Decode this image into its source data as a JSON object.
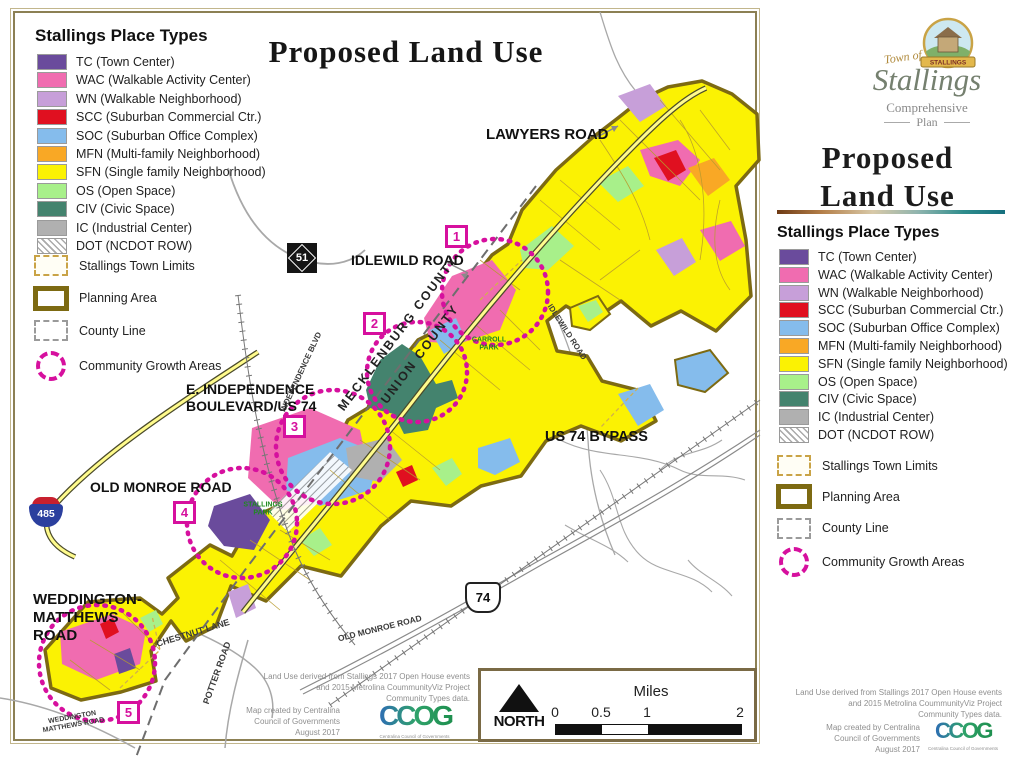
{
  "title": "Proposed Land Use",
  "legend": {
    "title": "Stallings Place Types",
    "place_types": [
      {
        "code": "TC",
        "label": "TC (Town Center)",
        "color": "#6A4B9C"
      },
      {
        "code": "WAC",
        "label": "WAC (Walkable Activity Center)",
        "color": "#F06CB0"
      },
      {
        "code": "WN",
        "label": "WN (Walkable Neighborhood)",
        "color": "#C79FD9"
      },
      {
        "code": "SCC",
        "label": "SCC (Suburban Commercial Ctr.)",
        "color": "#E01020"
      },
      {
        "code": "SOC",
        "label": "SOC (Suburban Office Complex)",
        "color": "#85BCEC"
      },
      {
        "code": "MFN",
        "label": "MFN (Multi-family Neighborhood)",
        "color": "#F9A825"
      },
      {
        "code": "SFN",
        "label": "SFN (Single family Neighborhood)",
        "color": "#FBF203"
      },
      {
        "code": "OS",
        "label": "OS (Open Space)",
        "color": "#A8F08A"
      },
      {
        "code": "CIV",
        "label": "CIV (Civic Space)",
        "color": "#44836E"
      },
      {
        "code": "IC",
        "label": "IC (Industrial Center)",
        "color": "#B0B0B0"
      },
      {
        "code": "DOT",
        "label": "DOT (NCDOT ROW)",
        "color": "#FFFFFF",
        "hatch": "hatched"
      }
    ],
    "boundaries": [
      {
        "label": "Stallings Town Limits",
        "symbol": "sym-town-limits"
      },
      {
        "label": "Planning Area",
        "symbol": "sym-planning-area"
      },
      {
        "label": "County Line",
        "symbol": "sym-county-line"
      },
      {
        "label": "Community Growth Areas",
        "symbol": "sym-growth"
      }
    ]
  },
  "map": {
    "labels": {
      "lawyers_road": "LAWYERS ROAD",
      "idlewild_road": "IDLEWILD ROAD",
      "e_independence": "E. INDEPENDENCE\nBOULEVARD/US 74",
      "us74_bypass": "US 74 BYPASS",
      "old_monroe_road": "OLD MONROE ROAD",
      "weddington_matthews": "WEDDINGTON-\nMATTHEWS\nROAD",
      "mecklenburg_county": "MECKLENBURG COUNTY",
      "union_county": "UNION COUNTY"
    },
    "road_labels": {
      "independence_blvd": "INDEPENDENCE BLVD",
      "idlewild_road": "IDLEWILD ROAD",
      "old_monroe_road": "OLD MONROE ROAD",
      "chestnut_lane": "CHESTNUT LANE",
      "potter_road": "POTTER ROAD",
      "weddington_matthews": "WEDDINGTON\nMATTHEWS ROAD"
    },
    "park_labels": {
      "carroll_park": "CARROLL\nPARK",
      "stallings_park": "STALLINGS\nPARK"
    },
    "growth_markers": [
      "1",
      "2",
      "3",
      "4",
      "5"
    ],
    "shields": {
      "nc51": "51",
      "us74": "74",
      "i485": "485"
    },
    "scale_bar": {
      "north_label": "NORTH",
      "units_label": "Miles",
      "ticks": [
        "0",
        "0.5",
        "1",
        "2"
      ]
    }
  },
  "attribution": {
    "source_lines": [
      "Land Use derived from Stallings 2017 Open House events",
      "and 2015 Metrolina CoummunityViz Project",
      "Community Types data."
    ],
    "credit_lines": [
      "Map created by Centralina",
      "Council of Governments",
      "August 2017"
    ],
    "ccog_logo": "CCOG",
    "ccog_caption": "Centralina Council of Governments"
  },
  "sidebar": {
    "logo": {
      "banner_text": "STALLINGS",
      "town_of": "Town of",
      "name": "Stallings",
      "plan_line1": "Comprehensive",
      "plan_line2": "Plan"
    },
    "title_line1": "Proposed",
    "title_line2": "Land Use"
  },
  "colors": {
    "growth_area": "#D6109E",
    "planning_area": "#7D6A12",
    "town_limits": "#C9A346",
    "county_line": "#9A9A9A",
    "highway_fill": "#FFFB8C"
  }
}
